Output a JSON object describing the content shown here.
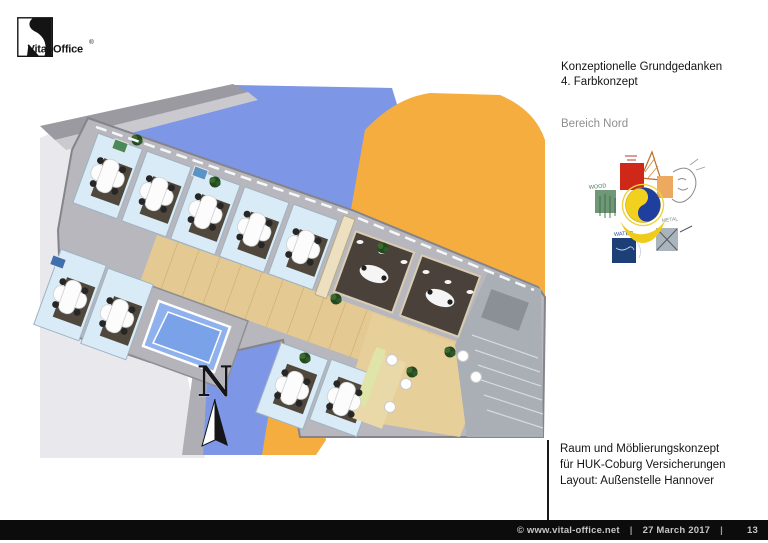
{
  "logo": {
    "brand_name": "Vital-Office",
    "registered_mark": "®"
  },
  "header": {
    "title_line1": "Konzeptionelle Grundgedanken",
    "title_line2": "4. Farbkonzept",
    "section_label": "Bereich Nord"
  },
  "concept_diagram": {
    "description": "five-elements color concept with yin-yang center",
    "elements": [
      {
        "name": "fire",
        "label": "FIRE",
        "color": "#d02818"
      },
      {
        "name": "earth",
        "label": "EARTH",
        "color": "#eda95f"
      },
      {
        "name": "metal",
        "label": "METAL",
        "color": "#aab4bd"
      },
      {
        "name": "water",
        "label": "WATER",
        "color": "#1c3f77"
      },
      {
        "name": "wood",
        "label": "WOOD",
        "color": "#6f9877"
      }
    ],
    "center": {
      "name": "yin-yang",
      "colors": [
        "#1e3f9e",
        "#f2d11e"
      ]
    }
  },
  "floor_plan": {
    "north_label": "N",
    "ground_colors": {
      "blue": "#7d97e6",
      "orange": "#f5ad3f",
      "light_gray": "#e9e9ed"
    }
  },
  "project_block": {
    "line1": "Raum und Möblierungskonzept",
    "line2": "für HUK-Coburg Versicherungen",
    "line3": "Layout: Außenstelle Hannover"
  },
  "status_bar": {
    "copyright": "©  www.vital-office.net",
    "separator": "|",
    "date": "27 March 2017",
    "page_number": "13"
  }
}
